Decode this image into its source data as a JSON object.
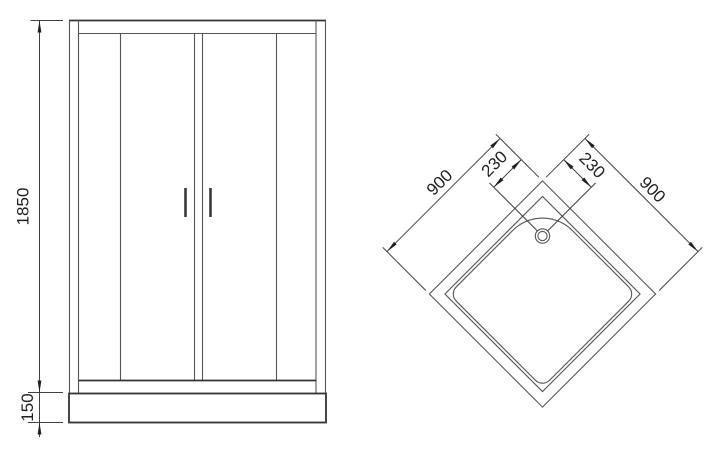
{
  "page": {
    "background": "#ffffff"
  },
  "drawing": {
    "line_color": "#555555",
    "bold_line_color": "#333333",
    "dimension_line_color": "#3f3f3f",
    "text_color": "#1f1f1f",
    "front_view": {
      "height_mm": "1850",
      "tray_height_mm": "150"
    },
    "top_view": {
      "side_left_mm": "900",
      "side_right_mm": "900",
      "drain_offset_left_mm": "230",
      "drain_offset_right_mm": "230"
    }
  }
}
